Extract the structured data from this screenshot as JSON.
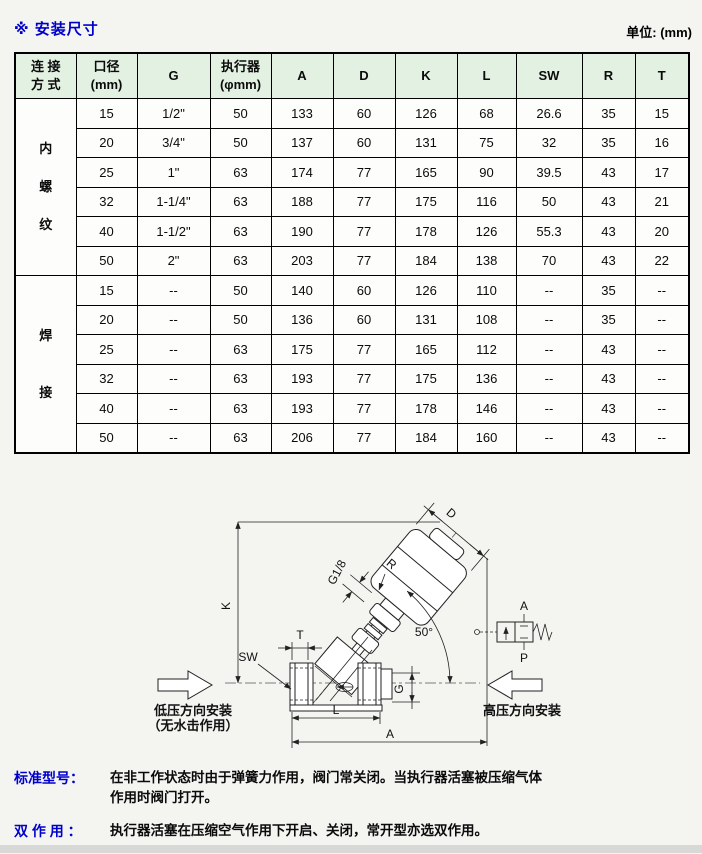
{
  "page": {
    "title": "※ 安装尺寸",
    "unit_label": "单位: (mm)"
  },
  "table": {
    "headers": [
      "连 接\n方 式",
      "口径\n(mm)",
      "G",
      "执行器\n(φmm)",
      "A",
      "D",
      "K",
      "L",
      "SW",
      "R",
      "T"
    ],
    "groups": [
      {
        "label": "内\n螺\n纹",
        "rows": [
          [
            "15",
            "1/2\"",
            "50",
            "133",
            "60",
            "126",
            "68",
            "26.6",
            "35",
            "15"
          ],
          [
            "20",
            "3/4\"",
            "50",
            "137",
            "60",
            "131",
            "75",
            "32",
            "35",
            "16"
          ],
          [
            "25",
            "1\"",
            "63",
            "174",
            "77",
            "165",
            "90",
            "39.5",
            "43",
            "17"
          ],
          [
            "32",
            "1-1/4\"",
            "63",
            "188",
            "77",
            "175",
            "116",
            "50",
            "43",
            "21"
          ],
          [
            "40",
            "1-1/2\"",
            "63",
            "190",
            "77",
            "178",
            "126",
            "55.3",
            "43",
            "20"
          ],
          [
            "50",
            "2\"",
            "63",
            "203",
            "77",
            "184",
            "138",
            "70",
            "43",
            "22"
          ]
        ]
      },
      {
        "label": "焊\n接",
        "rows": [
          [
            "15",
            "--",
            "50",
            "140",
            "60",
            "126",
            "110",
            "--",
            "35",
            "--"
          ],
          [
            "20",
            "--",
            "50",
            "136",
            "60",
            "131",
            "108",
            "--",
            "35",
            "--"
          ],
          [
            "25",
            "--",
            "63",
            "175",
            "77",
            "165",
            "112",
            "--",
            "43",
            "--"
          ],
          [
            "32",
            "--",
            "63",
            "193",
            "77",
            "175",
            "136",
            "--",
            "43",
            "--"
          ],
          [
            "40",
            "--",
            "63",
            "193",
            "77",
            "178",
            "146",
            "--",
            "43",
            "--"
          ],
          [
            "50",
            "--",
            "63",
            "206",
            "77",
            "184",
            "160",
            "--",
            "43",
            "--"
          ]
        ]
      }
    ]
  },
  "diagram": {
    "labels": {
      "k": "K",
      "t": "T",
      "sw": "SW",
      "g": "G",
      "l": "L",
      "a": "A",
      "d": "D",
      "r": "R",
      "g18": "G1/8",
      "angle": "50°",
      "port_a": "A",
      "port_p": "P"
    },
    "captions": {
      "low_pressure_line1": "低压方向安装",
      "low_pressure_line2": "（无水击作用）",
      "high_pressure": "高压方向安装"
    }
  },
  "notes": [
    {
      "label": "标准型号：",
      "text": "在非工作状态时由于弹簧力作用，阀门常关闭。当执行器活塞被压缩气体\n作用时阀门打开。"
    },
    {
      "label": "双 作 用 ：",
      "text": "执行器活塞在压缩空气作用下开启、关闭，常开型亦选双作用。"
    }
  ],
  "colors": {
    "accent_blue": "#0000cc",
    "header_green": "#e3f1e3",
    "page_bg": "#f4f4f1",
    "line": "#222222"
  }
}
